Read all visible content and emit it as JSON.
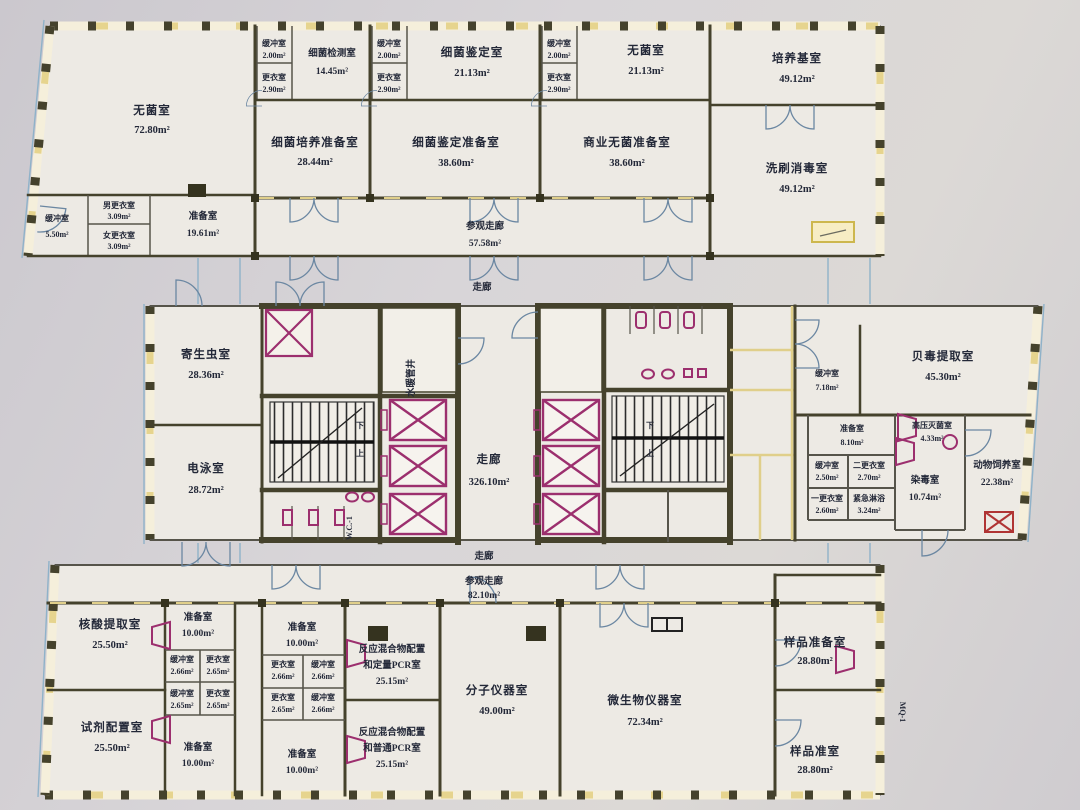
{
  "plan_title": "实验楼平面图",
  "colors": {
    "paper": "#d6d3d7",
    "floor": "#edeae4",
    "wall": "#45422c",
    "yellow_accent": "#e0cf8a",
    "magenta_fixture": "#9c2f6e",
    "blue_line": "#8fb2c9",
    "ink": "#232838",
    "red_box": "#b03434"
  },
  "icons": {
    "elevator": "crossed-box",
    "stairs": "tread-hatch",
    "door": "quarter-arc"
  },
  "rooms": {
    "aseptic_main": {
      "name": "无菌室",
      "area": "72.80m²"
    },
    "buffer_550": {
      "name": "缓冲室",
      "area": "5.50m²"
    },
    "men_change": {
      "name": "男更衣室",
      "area": "3.09m²"
    },
    "women_change": {
      "name": "女更衣室",
      "area": "3.09m²"
    },
    "prep_1961": {
      "name": "准备室",
      "area": "19.61m²"
    },
    "buffer_a": {
      "name": "缓冲室",
      "area": "2.00m²"
    },
    "change_a": {
      "name": "更衣室",
      "area": "2.90m²"
    },
    "bacteria_test": {
      "name": "细菌检测室",
      "area": "14.45m²"
    },
    "bacteria_culture_prep": {
      "name": "细菌培养准备室",
      "area": "28.44m²"
    },
    "buffer_b": {
      "name": "缓冲室",
      "area": "2.00m²"
    },
    "change_b": {
      "name": "更衣室",
      "area": "2.90m²"
    },
    "bacteria_id": {
      "name": "细菌鉴定室",
      "area": "21.13m²"
    },
    "bacteria_id_prep": {
      "name": "细菌鉴定准备室",
      "area": "38.60m²"
    },
    "buffer_c": {
      "name": "缓冲室",
      "area": "2.00m²"
    },
    "change_c": {
      "name": "更衣室",
      "area": "2.90m²"
    },
    "aseptic_small": {
      "name": "无菌室",
      "area": "21.13m²"
    },
    "commercial_aseptic_prep": {
      "name": "商业无菌准备室",
      "area": "38.60m²"
    },
    "culture_medium": {
      "name": "培养基室",
      "area": "49.12m²"
    },
    "washing_disinfection": {
      "name": "洗刷消毒室",
      "area": "49.12m²"
    },
    "visit_corridor_top": {
      "name": "参观走廊",
      "area": "57.58m²"
    },
    "corridor_top": {
      "name": "走廊"
    },
    "parasite": {
      "name": "寄生虫室",
      "area": "28.36m²"
    },
    "electrophoresis": {
      "name": "电泳室",
      "area": "28.72m²"
    },
    "pipe_shaft": {
      "name": "水暖管井"
    },
    "main_corridor": {
      "name": "走廊",
      "area": "326.10m²"
    },
    "wc1": {
      "name": "W.C.-1"
    },
    "stair_up": {
      "name": "上"
    },
    "stair_down": {
      "name": "下"
    },
    "shellfish_toxin": {
      "name": "贝毒提取室",
      "area": "45.30m²"
    },
    "buffer_718": {
      "name": "缓冲室",
      "area": "7.18m²"
    },
    "prep_810": {
      "name": "准备室",
      "area": "8.10m²"
    },
    "autoclave": {
      "name": "高压灭菌室",
      "area": "4.33m²"
    },
    "buffer_250": {
      "name": "缓冲室",
      "area": "2.50m²"
    },
    "second_change": {
      "name": "二更衣室",
      "area": "2.70m²"
    },
    "first_change": {
      "name": "一更衣室",
      "area": "2.60m²"
    },
    "emergency_shower": {
      "name": "紧急淋浴",
      "area": "3.24m²"
    },
    "contamination": {
      "name": "染毒室",
      "area": "10.74m²"
    },
    "animal_feeding": {
      "name": "动物饲养室",
      "area": "22.38m²"
    },
    "corridor_bottom": {
      "name": "走廊"
    },
    "visit_corridor_bottom": {
      "name": "参观走廊",
      "area": "82.10m²"
    },
    "nucleic_acid": {
      "name": "核酸提取室",
      "area": "25.50m²"
    },
    "reagent_prep": {
      "name": "试剂配置室",
      "area": "25.50m²"
    },
    "prep_tl": {
      "name": "准备室",
      "area": "10.00m²"
    },
    "buffer_l1": {
      "name": "缓冲室",
      "area": "2.66m²"
    },
    "change_l1": {
      "name": "更衣室",
      "area": "2.65m²"
    },
    "buffer_l2": {
      "name": "缓冲室",
      "area": "2.65m²"
    },
    "change_l2": {
      "name": "更衣室",
      "area": "2.65m²"
    },
    "prep_bl": {
      "name": "准备室",
      "area": "10.00m²"
    },
    "prep_tr": {
      "name": "准备室",
      "area": "10.00m²"
    },
    "change_r1": {
      "name": "更衣室",
      "area": "2.66m²"
    },
    "buffer_r1": {
      "name": "缓冲室",
      "area": "2.66m²"
    },
    "change_r2": {
      "name": "更衣室",
      "area": "2.65m²"
    },
    "buffer_r2": {
      "name": "缓冲室",
      "area": "2.66m²"
    },
    "prep_br": {
      "name": "准备室",
      "area": "10.00m²"
    },
    "pcr_quant": {
      "line1": "反应混合物配置",
      "line2": "和定量PCR室",
      "area": "25.15m²"
    },
    "pcr_normal": {
      "line1": "反应混合物配置",
      "line2": "和普通PCR室",
      "area": "25.15m²"
    },
    "molecular_instrument": {
      "name": "分子仪器室",
      "area": "49.00m²"
    },
    "microbio_instrument": {
      "name": "微生物仪器室",
      "area": "72.34m²"
    },
    "sample_prep_room": {
      "name": "样品准备室",
      "area": "28.80m²"
    },
    "sample_prep": {
      "name": "样品准室",
      "area": "28.80m²"
    },
    "mq1": {
      "name": "MQ-1"
    }
  }
}
